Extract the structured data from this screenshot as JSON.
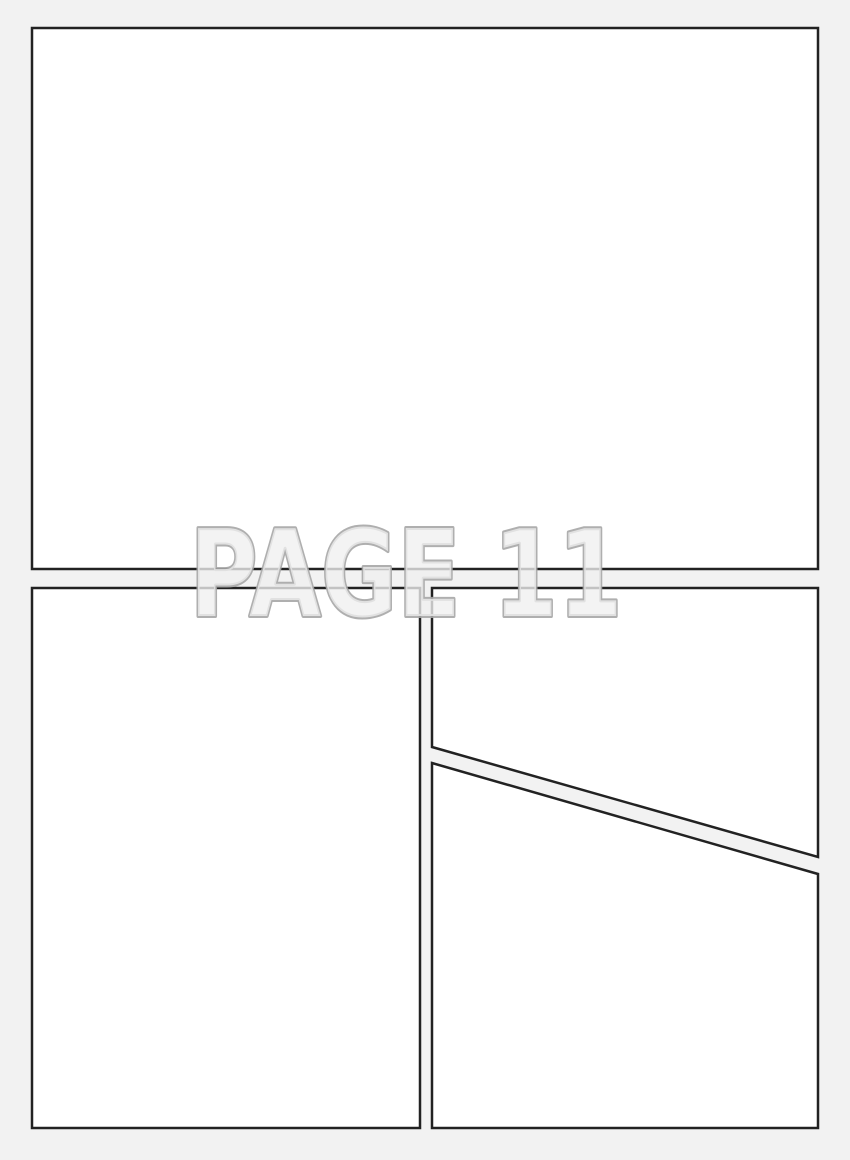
{
  "page": {
    "watermark_label": "PAGE 11"
  },
  "colors": {
    "background": "#f2f2f2",
    "panel_fill": "#ffffff",
    "panel_border": "#222222",
    "watermark_outline": "#a6a6a6",
    "watermark_fill": "#efefef"
  },
  "panels": [
    {
      "id": "panel-1",
      "description": "top full-width panel, empty"
    },
    {
      "id": "panel-2",
      "description": "bottom-left tall panel, empty"
    },
    {
      "id": "panel-3",
      "description": "bottom-right upper panel with diagonal bottom edge, empty"
    },
    {
      "id": "panel-4",
      "description": "bottom-right lower panel with diagonal top edge, empty"
    }
  ]
}
